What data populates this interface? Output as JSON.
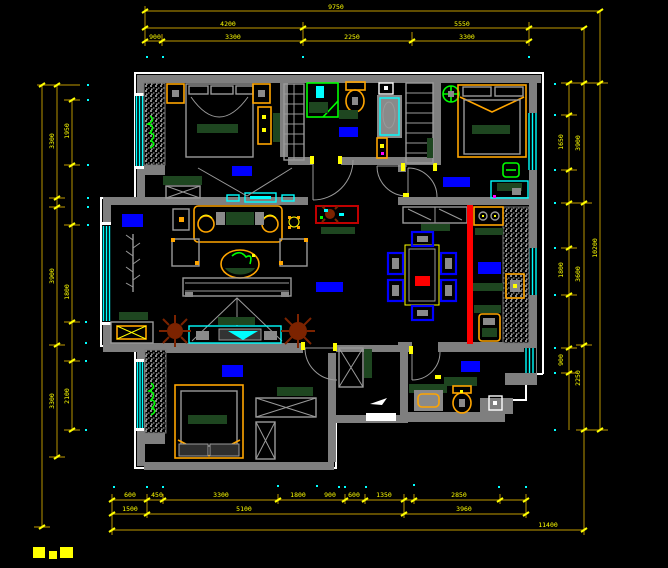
{
  "drawing": {
    "type": "apartment floor plan (CAD)",
    "background": "black canvas, no visible app chrome"
  },
  "colors": {
    "bg": "#000000",
    "wall": "#7F7F7F",
    "white": "#FFFFFF",
    "cyan": "#00FFFF",
    "blue": "#0000FF",
    "yellow": "#FFFF00",
    "orange": "#FFA500",
    "dim_line": "#9A7B00",
    "dark_green": "#1E4620",
    "bright_green": "#00FF00",
    "red": "#FF0000",
    "brown": "#7C2300",
    "magenta": "#FF00FF"
  },
  "symbols": {
    "bed-icon": "rect frame with pillow bar",
    "wardrobe-icon": "speckled strip",
    "shower-icon": "green square enclosure",
    "toilet-icon": "orange tank and bowl",
    "basin-icon": "orange rounded rect on gray counter",
    "washing-machine-icon": "white square with drum dot",
    "sofa-icon": "orange outline with green cushions",
    "tv-stand-icon": "cyan long rect with tv",
    "dining-table-icon": "yellow rect, red centre, blue chairs",
    "stove-icon": "orange rect with two burners",
    "ceiling-fan-icon": "green circle with cross",
    "plant-icon": "brown starburst",
    "door-arc": "gray quarter circle with yellow hinge",
    "window-glyph": "triple cyan parallel lines",
    "entry-arrow-icon": "small white arrow"
  },
  "room_labels": [
    {
      "x": 232,
      "y": 166,
      "w": 20,
      "h": 10
    },
    {
      "x": 339,
      "y": 127,
      "w": 19,
      "h": 10
    },
    {
      "x": 443,
      "y": 177,
      "w": 27,
      "h": 10
    },
    {
      "x": 122,
      "y": 214,
      "w": 21,
      "h": 13
    },
    {
      "x": 316,
      "y": 282,
      "w": 27,
      "h": 10
    },
    {
      "x": 478,
      "y": 262,
      "w": 23,
      "h": 12
    },
    {
      "x": 222,
      "y": 365,
      "w": 21,
      "h": 12
    },
    {
      "x": 461,
      "y": 361,
      "w": 19,
      "h": 11
    }
  ],
  "dim_labels": [
    {
      "t": "9750",
      "x": 336,
      "y": 9,
      "r": 0
    },
    {
      "t": "4200",
      "x": 228,
      "y": 26,
      "r": 0
    },
    {
      "t": "5550",
      "x": 462,
      "y": 26,
      "r": 0
    },
    {
      "t": "900",
      "x": 155,
      "y": 39,
      "r": 0
    },
    {
      "t": "3300",
      "x": 233,
      "y": 39,
      "r": 0
    },
    {
      "t": "2250",
      "x": 352,
      "y": 39,
      "r": 0
    },
    {
      "t": "3300",
      "x": 467,
      "y": 39,
      "r": 0
    },
    {
      "t": "3300",
      "x": 54,
      "y": 141,
      "r": -90
    },
    {
      "t": "3900",
      "x": 54,
      "y": 276,
      "r": -90
    },
    {
      "t": "3300",
      "x": 54,
      "y": 401,
      "r": -90
    },
    {
      "t": "1950",
      "x": 69,
      "y": 131,
      "r": -90
    },
    {
      "t": "1800",
      "x": 69,
      "y": 292,
      "r": -90
    },
    {
      "t": "2100",
      "x": 69,
      "y": 396,
      "r": -90
    },
    {
      "t": "1650",
      "x": 563,
      "y": 142,
      "r": -90
    },
    {
      "t": "1800",
      "x": 563,
      "y": 270,
      "r": -90
    },
    {
      "t": "900",
      "x": 563,
      "y": 360,
      "r": -90
    },
    {
      "t": "3900",
      "x": 580,
      "y": 143,
      "r": -90
    },
    {
      "t": "3600",
      "x": 580,
      "y": 274,
      "r": -90
    },
    {
      "t": "2250",
      "x": 580,
      "y": 378,
      "r": -90
    },
    {
      "t": "10200",
      "x": 597,
      "y": 248,
      "r": -90
    },
    {
      "t": "600",
      "x": 130,
      "y": 497,
      "r": 0
    },
    {
      "t": "450",
      "x": 157,
      "y": 497,
      "r": 0
    },
    {
      "t": "3300",
      "x": 221,
      "y": 497,
      "r": 0
    },
    {
      "t": "1800",
      "x": 298,
      "y": 497,
      "r": 0
    },
    {
      "t": "900",
      "x": 330,
      "y": 497,
      "r": 0
    },
    {
      "t": "600",
      "x": 354,
      "y": 497,
      "r": 0
    },
    {
      "t": "1350",
      "x": 384,
      "y": 497,
      "r": 0
    },
    {
      "t": "2850",
      "x": 459,
      "y": 497,
      "r": 0
    },
    {
      "t": "1500",
      "x": 130,
      "y": 511,
      "r": 0
    },
    {
      "t": "5100",
      "x": 244,
      "y": 511,
      "r": 0
    },
    {
      "t": "3960",
      "x": 464,
      "y": 511,
      "r": 0
    },
    {
      "t": "11400",
      "x": 548,
      "y": 527,
      "r": 0
    }
  ]
}
